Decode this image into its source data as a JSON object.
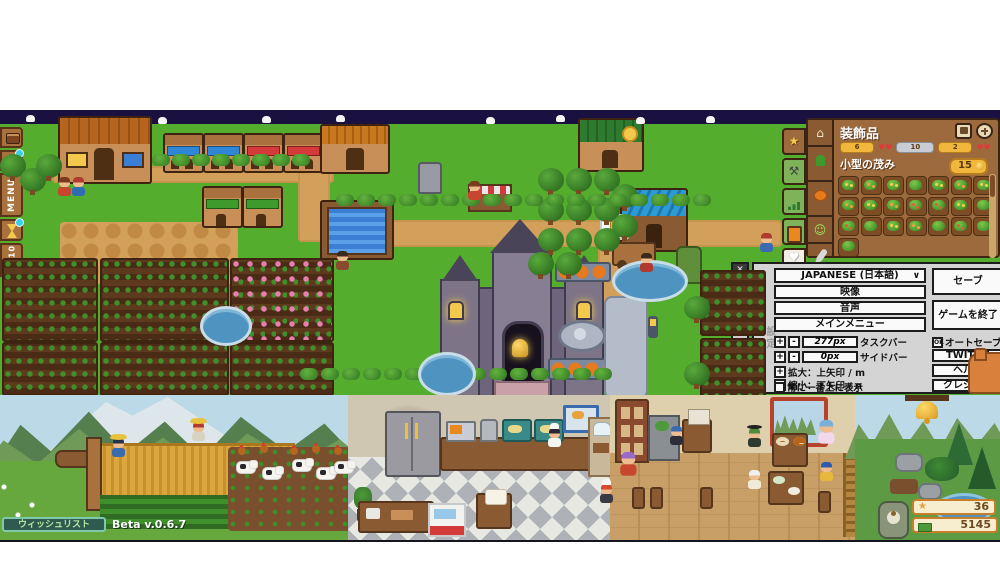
{
  "game": {
    "beta_version": "Beta v.0.6.7",
    "wishlist_label": "ウィッシュリスト"
  },
  "world_toolbar": {
    "menu_label": "MENU",
    "capacity_label": "10/10"
  },
  "inventory": {
    "title": "装飾品",
    "stats": [
      {
        "value": "6",
        "icon": "coin-yellow"
      },
      {
        "value": "10",
        "icon": "coin-silver"
      },
      {
        "value": "2",
        "icon": "coin-yellow"
      }
    ],
    "hearts_separator": "♥♥",
    "item_name": "小型の茂み",
    "item_price": "15",
    "slot_variants": [
      "b1",
      "b2",
      "b1",
      "p",
      "b1",
      "b2",
      "b1",
      "b2",
      "b1",
      "b2",
      "b3",
      "b3",
      "b1",
      "p",
      "b3",
      "p",
      "b1",
      "b2",
      "p",
      "b3",
      "p",
      "p"
    ],
    "outer_tabs": [
      "star",
      "anvil",
      "chart",
      "book",
      "heart"
    ],
    "inner_tabs": [
      "birdhouse",
      "plant",
      "pumpkin",
      "smiley",
      "wrench"
    ]
  },
  "settings": {
    "panel_title_vertical": "設定",
    "language_value": "JAPANESE (日本語)",
    "video_label": "映像",
    "audio_label": "音声",
    "main_menu_label": "メインメニュー",
    "taskbar_value": "277px",
    "taskbar_label": "タスクバー",
    "sidebar_value": "0px",
    "sidebar_label": "サイドバー",
    "zoom_in_label": "拡大：上矢印 / m",
    "zoom_out_label": "縮小：下矢印 / n",
    "always_on_top_label": "常に一番上に表示",
    "save_label": "セーブ",
    "quit_label": "ゲームを終了",
    "autosave_label": "オートセーブ",
    "autosave_state": "OK",
    "twitch_label": "TWITCH",
    "help_label": "ヘルプ",
    "credits_label": "クレジット",
    "plus": "+",
    "minus": "-"
  },
  "hud": {
    "star_count": "36",
    "money_count": "5145"
  },
  "icons": {
    "close": "✕",
    "chevron_down": "∨",
    "star": "★",
    "heart": "♥",
    "smiley": "☺",
    "anvil": "⚒",
    "house": "⌂"
  },
  "colors": {
    "grass": "#55ad2d",
    "night_sky": "#1a1140",
    "panel_brown": "#9c6a3c",
    "slot_brown": "#7d4e26",
    "accent_yellow": "#f0b73c",
    "settings_gray": "#d4d4d4",
    "water_blue": "#4f93c0",
    "badge_cream": "#f7eecf",
    "badge_border": "#c87d28"
  }
}
